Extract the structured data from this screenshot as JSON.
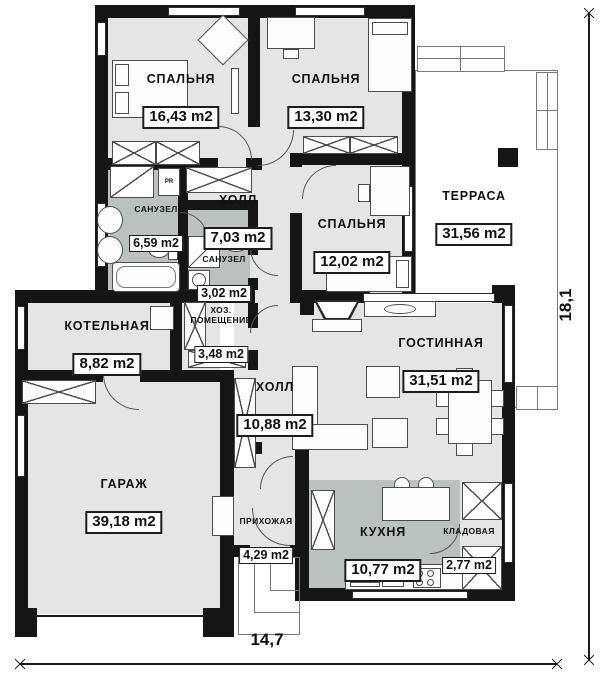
{
  "rooms": {
    "bedroom1": {
      "name": "СПАЛЬНЯ",
      "area": "16,43 m2"
    },
    "bedroom2": {
      "name": "СПАЛЬНЯ",
      "area": "13,30 m2"
    },
    "bedroom3": {
      "name": "СПАЛЬНЯ",
      "area": "12,02 m2"
    },
    "hall1": {
      "name": "ХОЛЛ",
      "area": "7,03 m2"
    },
    "bath1": {
      "name": "САНУЗЕЛ",
      "area": "6,59 m2"
    },
    "bath2": {
      "name": "САНУЗЕЛ",
      "area": "3,02 m2"
    },
    "terrace": {
      "name": "ТЕРРАСА",
      "area": "31,56 m2"
    },
    "boiler": {
      "name": "КОТЕЛЬНАЯ",
      "area": "8,82 m2"
    },
    "utility": {
      "name": "ХОЗ.\nПОМЕЩЕНИЕ",
      "area": "3,48 m2"
    },
    "living": {
      "name": "ГОСТИННАЯ",
      "area": "31,51 m2"
    },
    "hall2": {
      "name": "ХОЛЛ",
      "area": "10,88 m2"
    },
    "garage": {
      "name": "ГАРАЖ",
      "area": "39,18 m2"
    },
    "entry": {
      "name": "ПРИХОЖАЯ",
      "area": "4,29 m2"
    },
    "kitchen": {
      "name": "КУХНЯ",
      "area": "10,77 m2"
    },
    "pantry": {
      "name": "КЛАДОВАЯ",
      "area": "2,77 m2"
    }
  },
  "dimensions": {
    "width": "14,7",
    "height": "18,1"
  },
  "labels": {
    "pr": "PR"
  },
  "colors": {
    "wall": "#151515",
    "floor": "#e3e6e4",
    "wet_floor": "#b9c2be",
    "terrace": "#ffffff"
  }
}
